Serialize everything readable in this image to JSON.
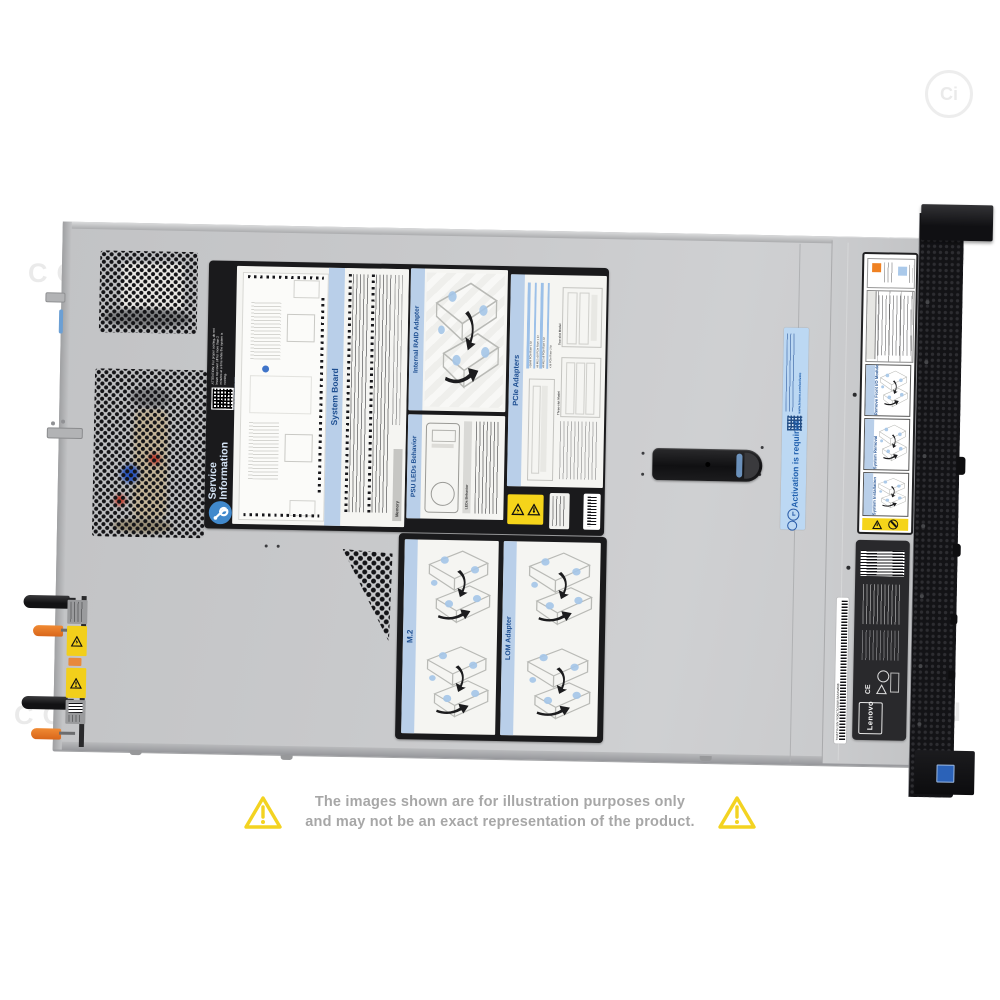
{
  "watermarks": {
    "text": "COMPAN",
    "text_partial": "PAN",
    "logo_text": "Ci"
  },
  "disclaimer": {
    "line1": "The images shown are for illustration purposes only",
    "line2": "and may not be an exact representation of the product."
  },
  "service_label": {
    "brand_line1": "Service",
    "brand_line2": "Information",
    "attention": "ATTENTION: For proper cooling, do not leave top cover off for more than 2 minutes at a time while the system is running.",
    "qr_url": "https://support.lenovo.com",
    "system_board": {
      "title": "System Board",
      "memory_header": "Memory"
    },
    "internal_raid": {
      "title": "Internal RAID Adapter"
    },
    "pcie": {
      "title": "PCIe Adapters",
      "kits": [
        "x16/x8 PCIe Riser 1 kit",
        "x8 ML2 x16 PCIe Riser 1 kit",
        "x8 ML2 x8 PCIe Riser 1 kit",
        "x16 PCIe Riser 2 kit"
      ],
      "caption_two_slot": "Two-slot Model",
      "caption_three_slot": "Three-slot Model"
    },
    "psu_leds": {
      "title": "PSU LEDs Behavior",
      "table_header": "LEDs Behavior"
    },
    "m2": {
      "title": "M.2"
    },
    "lom": {
      "title": "LOM Adapter"
    }
  },
  "activation_label": {
    "title": "Activation is required",
    "url": "www.lenovo.com/activate"
  },
  "rail_label": {
    "sections": [
      "Remove Front I/O Module",
      "System Removal",
      "System Installation"
    ]
  },
  "regulatory_label": {
    "brand": "Lenovo",
    "serial": "7X06TYH S/N 7X06CTO1WW BAAXW688"
  },
  "colors": {
    "chassis": "#c8c9cb",
    "label_black": "#1a1a1c",
    "panel_blue_bar": "#b9cfe9",
    "panel_blue_text": "#1d4e91",
    "activation_bg": "#bcd8f3",
    "activation_text": "#1f5fae",
    "warning_yellow": "#f5d41a",
    "orange": "#e0701f",
    "bezel_black": "#131316"
  }
}
